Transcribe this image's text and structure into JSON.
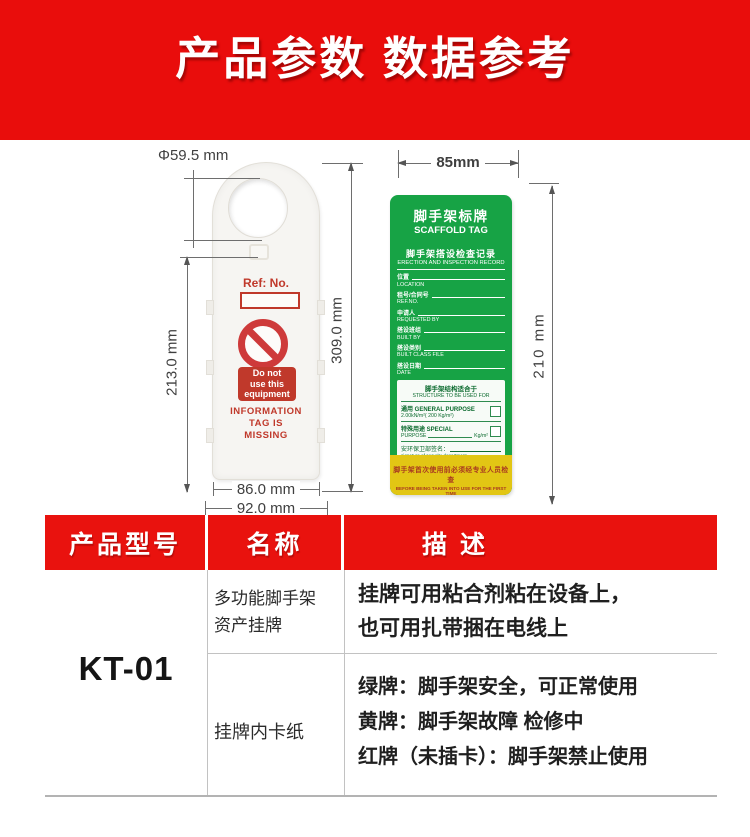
{
  "banner": {
    "title": "产品参数 数据参考"
  },
  "colors": {
    "banner_red": "#e90d0c",
    "table_header_red": "#e9120e",
    "card_green": "#17a345",
    "strip_yellow": "#e2c614",
    "warning_red": "#c0392b"
  },
  "tag_diagram": {
    "dim_hole": "Φ59.5 mm",
    "dim_total_height": "309.0 mm",
    "dim_body_height": "213.0 mm",
    "dim_inner_width": "86.0 mm",
    "dim_outer_width": "92.0 mm",
    "ref_label": "Ref: No.",
    "warning_lines": [
      "Do not",
      "use this",
      "equipment"
    ],
    "missing_lines": [
      "INFORMATION",
      "TAG IS",
      "MISSING"
    ]
  },
  "card_diagram": {
    "dim_width": "85mm",
    "dim_height": "210 mm",
    "title_cn": "脚手架标牌",
    "title_en": "SCAFFOLD TAG",
    "subtitle_cn": "脚手架搭设检查记录",
    "subtitle_en": "ERECTION AND INSPECTION RECORD",
    "fields": [
      {
        "cn": "位置",
        "en": "LOCATION"
      },
      {
        "cn": "租号/合同号",
        "en": "REF.NO."
      },
      {
        "cn": "申请人",
        "en": "REQUESTED BY"
      },
      {
        "cn": "搭设班组",
        "en": "BUILT BY"
      },
      {
        "cn": "搭设类别",
        "en": "BUILT CLASS FILE"
      },
      {
        "cn": "搭设日期",
        "en": "DATE"
      }
    ],
    "structure_cn": "脚手架结构适合于",
    "structure_en": "STRUCTURE TO BE USED FOR",
    "general_l1": "通用  GENERAL PURPOSE",
    "general_l2": "2.00kN/m²( 200 Kg/m²)",
    "special_l1": "特殊用途 SPECIAL",
    "special_l2": "PURPOSE",
    "special_unit": "Kg/m²",
    "sign_cn": "安环保卫部签名：",
    "sign_en": "signature of security department",
    "date_label": "日期  DATE",
    "notice_cn": "脚手架首次使用前必须经专业人员检查",
    "notice_en": "BEFORE BEING TAKEN INTO USE FOR THE FIRST TIME"
  },
  "table": {
    "headers": [
      "产品型号",
      "名称",
      "描 述"
    ],
    "model": "KT-01",
    "row1": {
      "name_lines": [
        "多功能脚手架",
        "资产挂牌"
      ],
      "desc_lines": [
        "挂牌可用粘合剂粘在设备上，",
        "也可用扎带捆在电线上"
      ]
    },
    "row2": {
      "name": "挂牌内卡纸",
      "desc_lines": [
        "绿牌：脚手架安全，可正常使用",
        "黄牌：脚手架故障  检修中",
        "红牌（未插卡）：脚手架禁止使用"
      ]
    }
  }
}
